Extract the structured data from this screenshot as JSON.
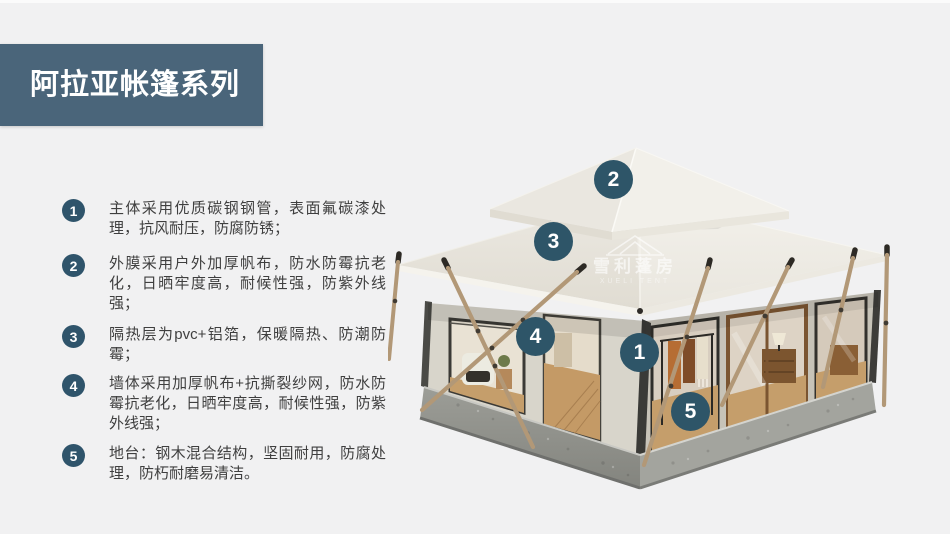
{
  "header": {
    "title": "阿拉亚帐篷系列"
  },
  "features": [
    {
      "num": "1",
      "text": "主体采用优质碳钢钢管，表面氟碳漆处理，抗风耐压，防腐防锈；"
    },
    {
      "num": "2",
      "text": "外膜采用户外加厚帆布，防水防霉抗老化，日晒牢度高，耐候性强，防紫外线强；"
    },
    {
      "num": "3",
      "text": "隔热层为pvc+铝箔，保暖隔热、防潮防霉；"
    },
    {
      "num": "4",
      "text": "墙体采用加厚帆布+抗撕裂纱网，防水防霉抗老化，日晒牢度高，耐候性强，防紫外线强；"
    },
    {
      "num": "5",
      "text": "地台：钢木混合结构，坚固耐用，防腐处理，防朽耐磨易清洁。"
    }
  ],
  "callouts": [
    {
      "num": "1"
    },
    {
      "num": "2"
    },
    {
      "num": "3"
    },
    {
      "num": "4"
    },
    {
      "num": "5"
    }
  ],
  "watermark": {
    "cn": "雪利蓬房",
    "en": "XUELI TENT"
  },
  "colors": {
    "title_bar": "#4a657a",
    "list_badge": "#2f546b",
    "tent_callout": "#2e5568",
    "background": "#f1f1f2",
    "roof_canvas": "#eae7e0",
    "wall_canvas": "#d8d5cb",
    "platform_concrete": "#95968f",
    "wood_pole": "#b29877",
    "wood_floor": "#c59e6b"
  }
}
